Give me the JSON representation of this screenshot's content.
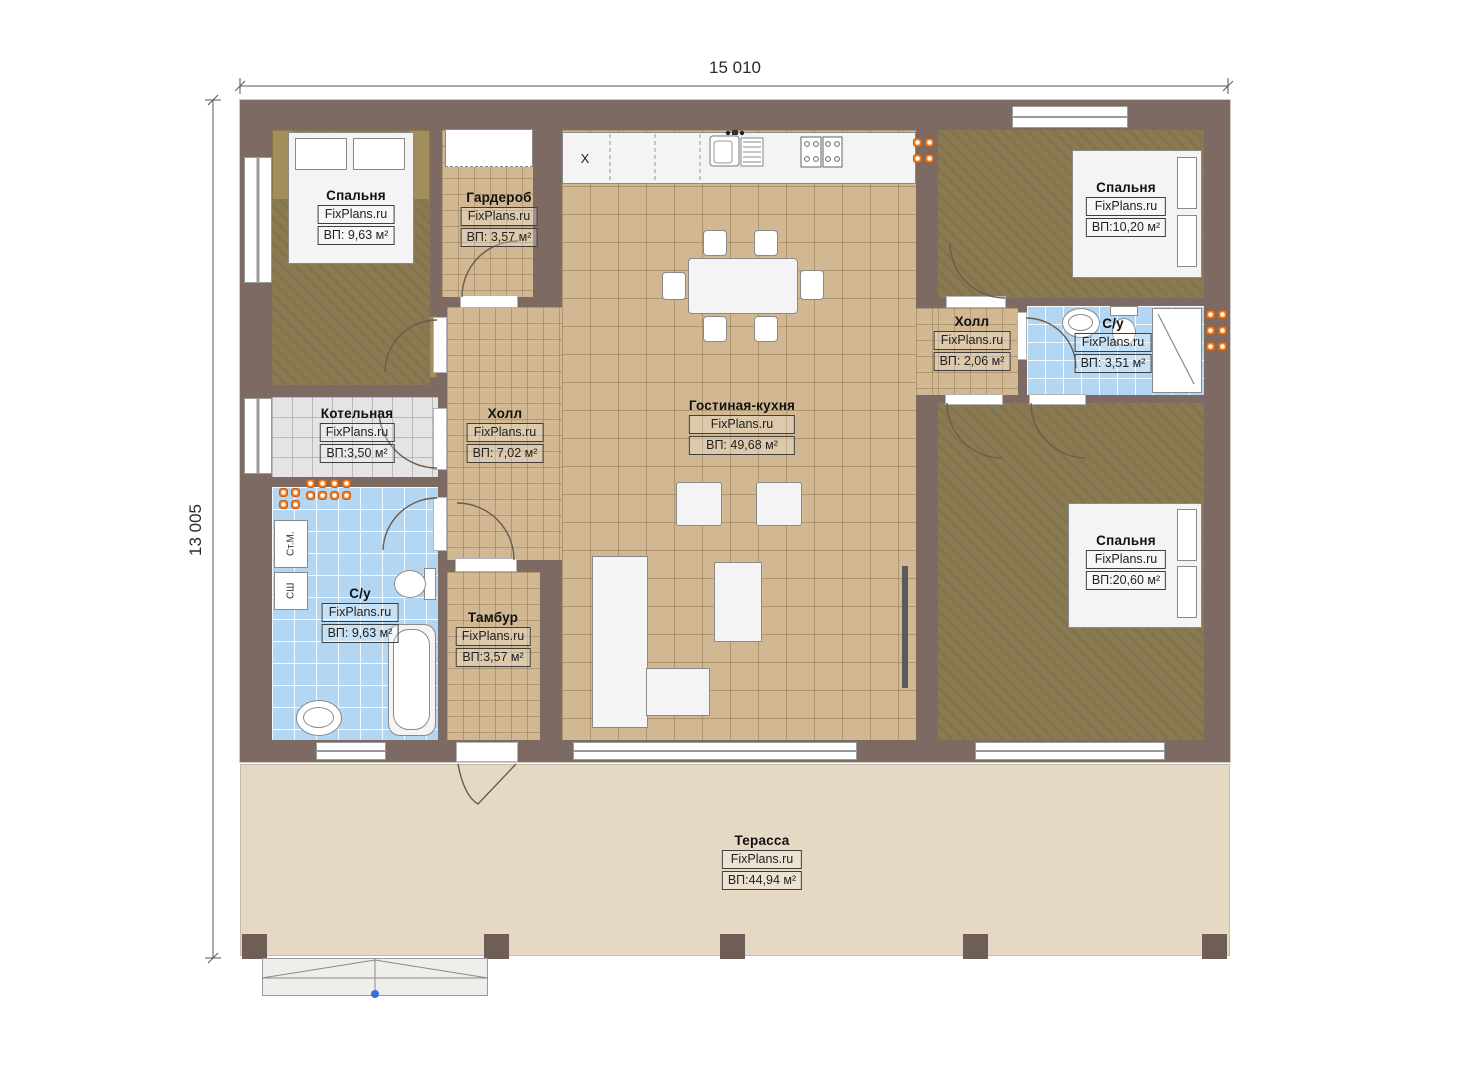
{
  "dimensions": {
    "top": "15 010",
    "left": "13 005"
  },
  "watermark": "FixPlans.ru",
  "rooms": [
    {
      "key": "bedroom-top-left",
      "name": "Спальня",
      "area": "ВП: 9,63 м²"
    },
    {
      "key": "wardrobe",
      "name": "Гардероб",
      "area": "ВП: 3,57 м²"
    },
    {
      "key": "boiler-room",
      "name": "Котельная",
      "area": "ВП:3,50 м²"
    },
    {
      "key": "hall-center",
      "name": "Холл",
      "area": "ВП: 7,02 м²"
    },
    {
      "key": "living-kitchen",
      "name": "Гостиная-кухня",
      "area": "ВП: 49,68 м²"
    },
    {
      "key": "bathroom-left",
      "name": "С/у",
      "area": "ВП: 9,63 м²"
    },
    {
      "key": "vestibule",
      "name": "Тамбур",
      "area": "ВП:3,57 м²"
    },
    {
      "key": "hall-right",
      "name": "Холл",
      "area": "ВП: 2,06 м²"
    },
    {
      "key": "bathroom-right",
      "name": "С/у",
      "area": "ВП: 3,51 м²"
    },
    {
      "key": "bedroom-top-right",
      "name": "Спальня",
      "area": "ВП:10,20 м²"
    },
    {
      "key": "bedroom-bottom-right",
      "name": "Спальня",
      "area": "ВП:20,60 м²"
    },
    {
      "key": "terrace",
      "name": "Терасса",
      "area": "ВП:44,94 м²"
    }
  ],
  "appliance_labels": {
    "washing_machine": "Ст.М.",
    "dryer_cabinet": "СШ",
    "kitchen_closet": "X"
  },
  "colors": {
    "wall": "#7d6b63",
    "floor_wood_dark": "#8a7a52",
    "floor_tile_tan": "#d2b892",
    "floor_tile_blue": "#b3d6f2",
    "floor_tile_gray": "#e4e4e4",
    "terrace": "#e6d9c3",
    "radiator": "#f07c20",
    "marker_blue": "#3a6fd8"
  }
}
